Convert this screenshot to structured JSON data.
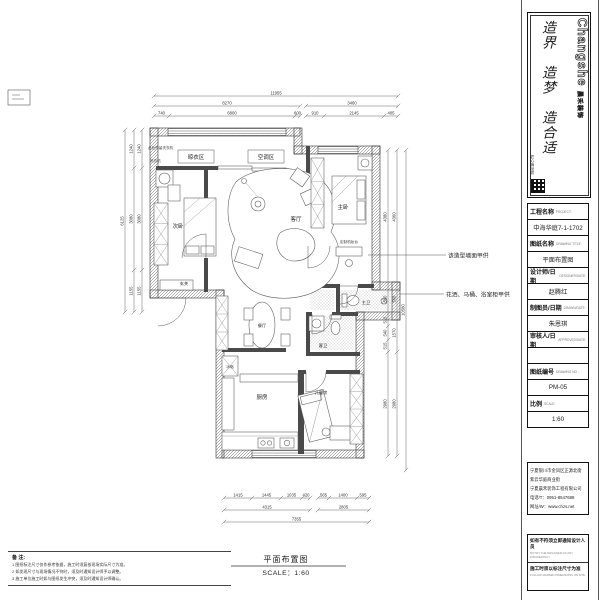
{
  "logo": {
    "brand_en": "Changshe",
    "brand_cn": "晨禾装饰",
    "slogan": "造界　造梦　造合适",
    "seal_text": "匠心铸品质"
  },
  "title_block": {
    "rows": [
      {
        "cn": "工程名称",
        "en": "PROJECT:"
      },
      {
        "text": "中海华庭7-1-1702"
      },
      {
        "cn": "图纸名称",
        "en": "DRAWING TITLE:"
      },
      {
        "text": "平面布置图"
      },
      {
        "cn": "设计师/日期",
        "en": "DESIGNER/DATE:"
      },
      {
        "text": "赵腾红"
      },
      {
        "cn": "制图员/日期",
        "en": "DRAWN/DATE:"
      },
      {
        "text": "朱恩琪"
      },
      {
        "cn": "审核人/日期",
        "en": "APPROVED/DATE:"
      },
      {
        "text": ""
      },
      {
        "cn": "图纸编号",
        "en": "DRAWING NO.:"
      },
      {
        "text": "PM-05"
      },
      {
        "cn": "比例",
        "en": "SCALE:"
      },
      {
        "text": "1:60"
      }
    ]
  },
  "company": {
    "address1": "宁夏银川市金凤区正源北街",
    "address2": "紫云华庭商业街",
    "name": "宁夏晨禾装饰工程有限公司",
    "phone": "电话/T：0951-8547688",
    "website": "网址/W：www.chzs.net"
  },
  "warnings": {
    "line1_cn": "如有不符须立即通知设计人员",
    "line1_en": "NOTIFY THE DESIGNER OF ANY DISCREPANCY",
    "line2_cn": "施工时须以标注尺寸为准",
    "line2_en": "FOLLOW MARKED DIMENSIONS ON SITE"
  },
  "rooms": {
    "liangyi": "晾衣区",
    "kongtiao": "空调区",
    "ciwo": "次卧",
    "keting": "客厅",
    "zhuwo": "主卧",
    "shuzhuangtai": "定制梳妆台",
    "zhuwei": "主卫",
    "kewei": "客卫",
    "ertongfang": "儿童房",
    "canting": "餐厅",
    "chufang": "厨房",
    "xuanguan": "玄关",
    "bingxiang": "冰箱",
    "xiyiji": "洗衣机",
    "reserve_note": "此处预留洗衣机"
  },
  "annotations": {
    "wall_note": "该造型墙面甲供",
    "bath_note": "花洒、马桶、浴室柜甲供"
  },
  "footer": {
    "symbol": "P",
    "title": "平面布置图",
    "scale": "SCALE：1:60"
  },
  "notes": {
    "heading": "备 注:",
    "items": [
      "1 图纸标注尺寸仅作参考依据，施工时须复核现场实际尺寸为准。",
      "2 如发现尺寸与现场情况不符时，须及时通知设计师予以调整。",
      "3 施工单位施工时如与图纸发生冲突，须及时通知设计师确认。"
    ]
  },
  "dimensions": {
    "chains": [
      {
        "o": "h",
        "c": 96,
        "t": [
          154,
          398
        ],
        "l": [
          "11955"
        ]
      },
      {
        "o": "h",
        "c": 106,
        "t": [
          154,
          300
        ],
        "l": [
          "8270"
        ]
      },
      {
        "o": "h",
        "c": 106,
        "t": [
          306,
          398
        ],
        "l": [
          "3460"
        ]
      },
      {
        "o": "h",
        "c": 116,
        "t": [
          154,
          169,
          295,
          300
        ],
        "l": [
          "740",
          "6800",
          "600"
        ]
      },
      {
        "o": "h",
        "c": 116,
        "t": [
          306,
          324,
          384,
          398
        ],
        "l": [
          "910",
          "2145",
          "405"
        ]
      },
      {
        "o": "v",
        "c": 125,
        "t": [
          130,
          312
        ],
        "l": [
          "6125"
        ]
      },
      {
        "o": "v",
        "c": 134,
        "t": [
          130,
          168,
          270,
          312
        ],
        "l": [
          "1240",
          "3080",
          "1155"
        ]
      },
      {
        "o": "v",
        "c": 142,
        "t": [
          130,
          168,
          270,
          312
        ],
        "l": [
          "1240",
          "3080",
          "1155"
        ]
      },
      {
        "o": "v",
        "c": 388,
        "t": [
          150,
          284,
          314,
          326,
          340,
          352,
          456
        ],
        "l": [
          "4380",
          "560",
          "515",
          "540",
          "515",
          "2980"
        ]
      },
      {
        "o": "v",
        "c": 397,
        "t": [
          150,
          284,
          314,
          352,
          456
        ],
        "l": [
          "4360",
          "560",
          "1570",
          "2980"
        ]
      },
      {
        "o": "v",
        "c": 406,
        "t": [
          150,
          470
        ],
        "l": [
          "10580"
        ]
      },
      {
        "o": "h",
        "c": 498,
        "t": [
          224,
          252,
          281,
          302,
          310
        ],
        "l": [
          "1415",
          "1445",
          "1035",
          "420"
        ]
      },
      {
        "o": "h",
        "c": 498,
        "t": [
          318,
          329,
          357,
          369
        ],
        "l": [
          "565",
          "1400",
          "595"
        ]
      },
      {
        "o": "h",
        "c": 510,
        "t": [
          224,
          310
        ],
        "l": [
          "4315"
        ]
      },
      {
        "o": "h",
        "c": 510,
        "t": [
          318,
          369
        ],
        "l": [
          "2805"
        ]
      },
      {
        "o": "h",
        "c": 522,
        "t": [
          224,
          369
        ],
        "l": [
          "7355"
        ]
      }
    ]
  }
}
